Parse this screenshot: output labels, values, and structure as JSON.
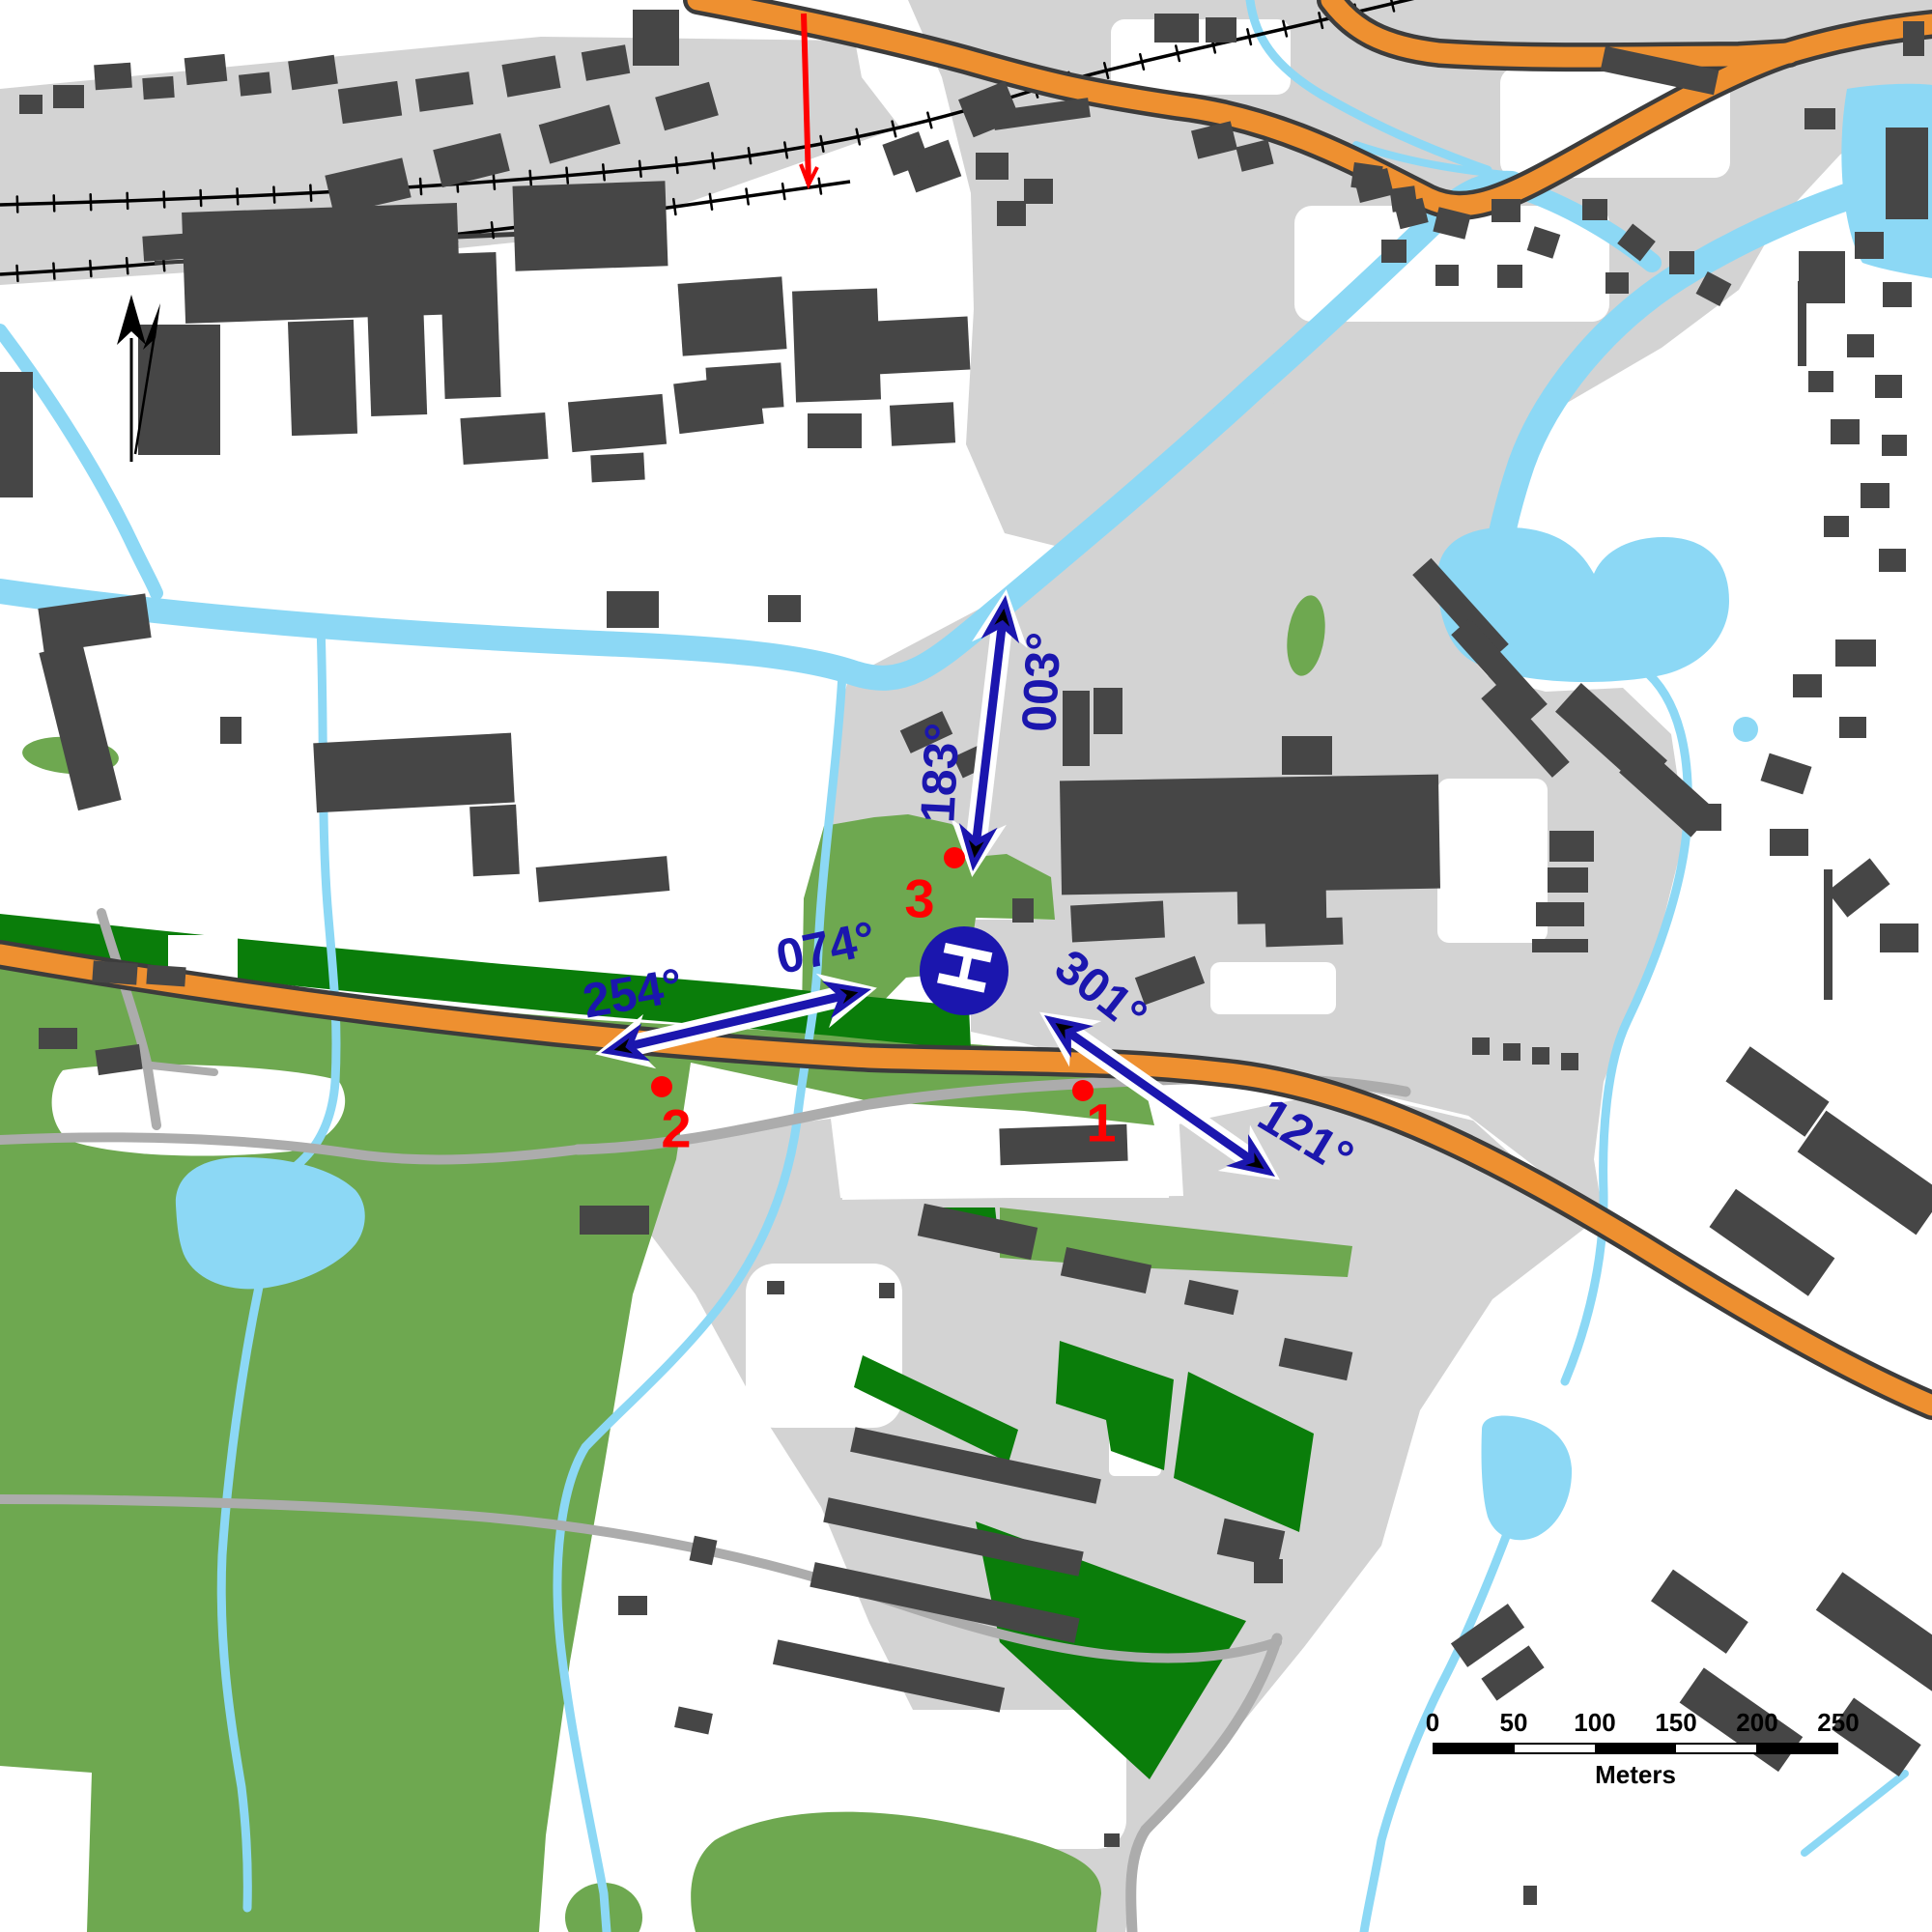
{
  "annotations": {
    "bearings": [
      {
        "label": "003°"
      },
      {
        "label": "183°"
      },
      {
        "label": "074°"
      },
      {
        "label": "254°"
      },
      {
        "label": "301°"
      },
      {
        "label": "121°"
      }
    ],
    "points": [
      {
        "label": "1"
      },
      {
        "label": "2"
      },
      {
        "label": "3"
      }
    ],
    "helipad": {
      "label": "H"
    }
  },
  "scalebar": {
    "ticks": [
      "0",
      "50",
      "100",
      "150",
      "200",
      "250"
    ],
    "unit": "Meters"
  },
  "colors": {
    "annotation_blue": "#1B16AE",
    "annotation_red": "#FF0000",
    "water": "#8CD8F5",
    "urban_gray": "#D3D3D3",
    "building_gray": "#464646",
    "road_major_orange": "#EE9030",
    "road_minor_gray": "#ACACAC",
    "green_area": "#6EA850",
    "green_dark": "#0A7D0A",
    "railway_black": "#000000",
    "survey_line_red": "#FF0000"
  },
  "icons": {
    "north_arrow": "declination-north-arrows",
    "helipad": "helipad-icon"
  }
}
